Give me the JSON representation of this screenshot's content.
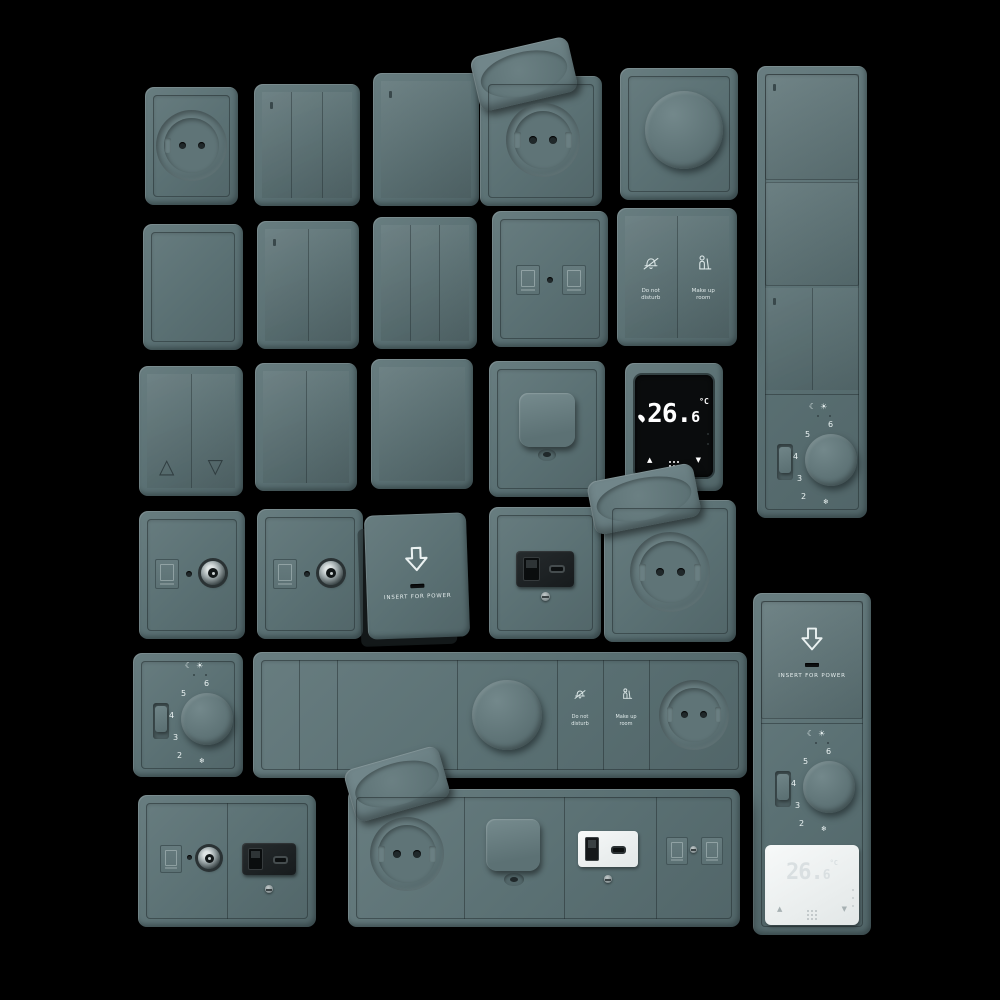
{
  "scene": {
    "background": "#000000",
    "description": "3D render catalog of wall switches, sockets and thermostats in gray-teal finish on black background"
  },
  "colors": {
    "plate": "#5d7377",
    "plate_highlight": "#6e8386",
    "plate_shadow": "#4a5c5f",
    "screen_black": "#0a0c0d",
    "display_digits": "#ffffff",
    "module_black": "#1d2123",
    "module_white": "#f2f4f5",
    "metal_coax": "#aab3b5"
  },
  "labels": {
    "do_not_disturb": [
      "Do not",
      "disturb"
    ],
    "make_up_room": [
      "Make up",
      "room"
    ],
    "insert_for_power": "INSERT FOR POWER",
    "temp_main": "26.",
    "temp_decimal": "6",
    "temp_unit": "°C",
    "dial": [
      "6",
      "5",
      "4",
      "3",
      "2"
    ],
    "dial_frost": "❄",
    "mode_night": "☾",
    "mode_day": "☀",
    "arrow_up": "▲",
    "arrow_down": "▼",
    "shutter_up": "△",
    "shutter_down": "▽"
  },
  "items": [
    {
      "name": "round-pin-socket",
      "type": "socket"
    },
    {
      "name": "switch-3-gang",
      "type": "switch"
    },
    {
      "name": "switch-1-gang",
      "type": "switch"
    },
    {
      "name": "socket-flip-lid-open",
      "type": "socket"
    },
    {
      "name": "rotary-dimmer",
      "type": "dimmer"
    },
    {
      "name": "vertical-multi-frame-switches-thermostat",
      "type": "multi-frame"
    },
    {
      "name": "blank-plate",
      "type": "blank"
    },
    {
      "name": "switch-2-gang",
      "type": "switch"
    },
    {
      "name": "switch-3-gang",
      "type": "switch"
    },
    {
      "name": "data-socket-2-port",
      "type": "data"
    },
    {
      "name": "hotel-service-switch",
      "type": "switch",
      "labels": [
        "Do not disturb",
        "Make up room"
      ]
    },
    {
      "name": "shutter-switch",
      "type": "switch"
    },
    {
      "name": "switch-2-gang",
      "type": "switch"
    },
    {
      "name": "switch-1-gang",
      "type": "switch"
    },
    {
      "name": "cable-outlet",
      "type": "outlet"
    },
    {
      "name": "digital-thermostat-black",
      "type": "thermostat",
      "reading": "26.6 °C"
    },
    {
      "name": "tv-coax-socket",
      "type": "data"
    },
    {
      "name": "tv-coax-socket",
      "type": "data"
    },
    {
      "name": "key-card-switch",
      "type": "switch",
      "label": "INSERT FOR POWER"
    },
    {
      "name": "usb-socket-black",
      "type": "usb"
    },
    {
      "name": "socket-flip-lid-open",
      "type": "socket"
    },
    {
      "name": "analog-thermostat-dial",
      "type": "thermostat",
      "dial_range": "2–6"
    },
    {
      "name": "horizontal-multi-frame-switch-dimmer-service-socket",
      "type": "multi-frame"
    },
    {
      "name": "vertical-multi-frame-card-dial-thermostat",
      "type": "multi-frame"
    },
    {
      "name": "combo-tv-usb-plate",
      "type": "multi-frame"
    },
    {
      "name": "horizontal-multi-frame-socket-outlet-usb-data",
      "type": "multi-frame"
    }
  ]
}
